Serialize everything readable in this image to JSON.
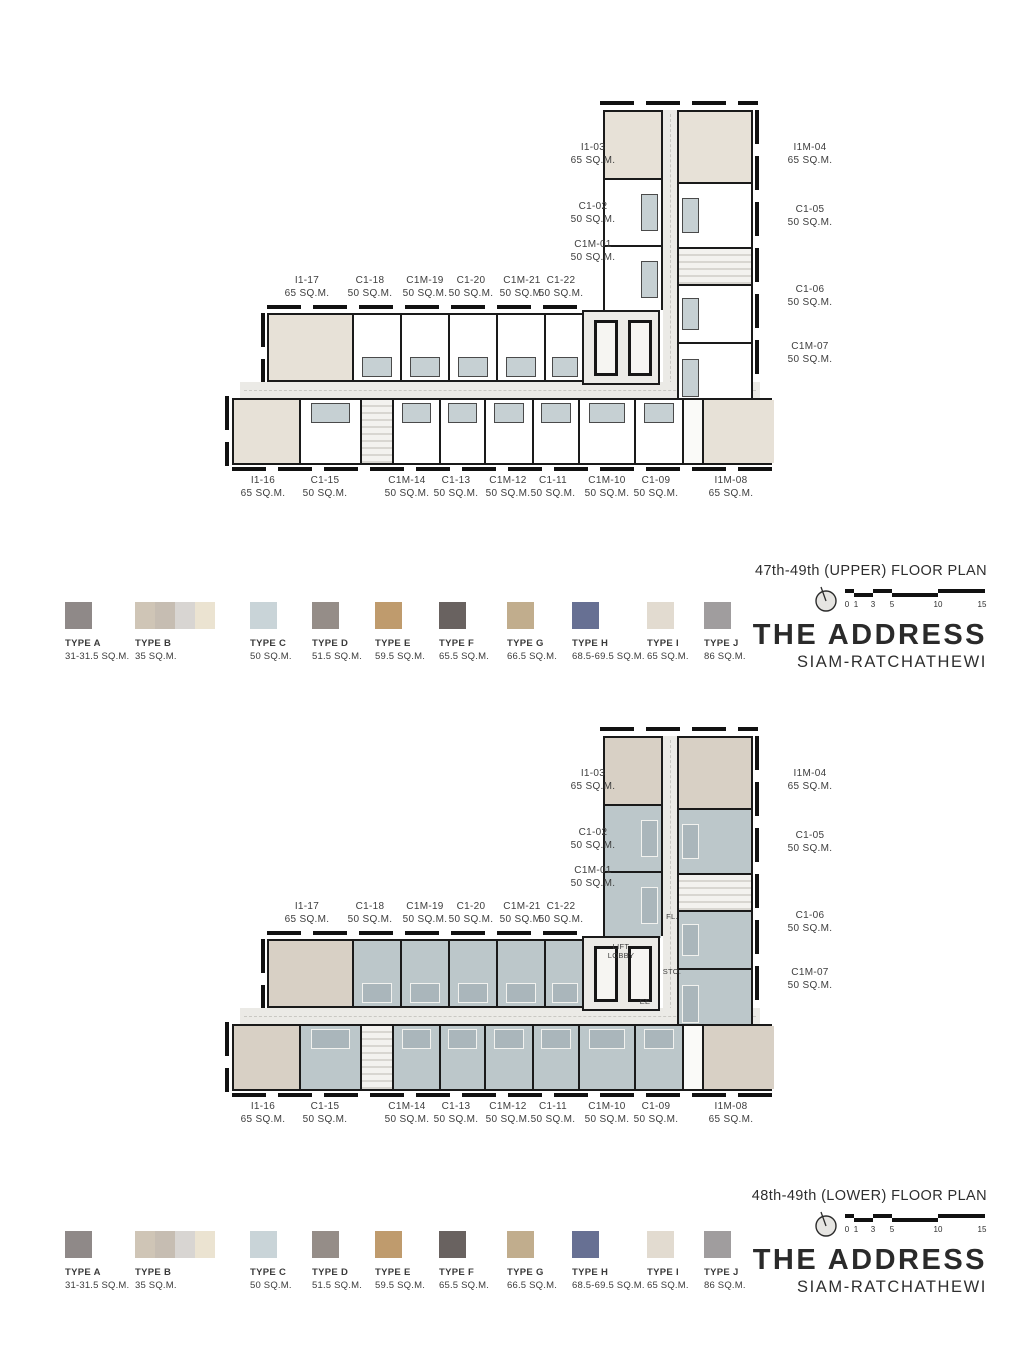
{
  "brand": {
    "title": "THE ADDRESS",
    "subtitle": "SIAM-RATCHATHEWI"
  },
  "plans": [
    {
      "title": "47th-49th (UPPER) FLOOR PLAN"
    },
    {
      "title": "48th-49th (LOWER) FLOOR PLAN"
    }
  ],
  "scalebar": {
    "ticks": [
      "0",
      "1",
      "3",
      "5",
      "10",
      "15"
    ]
  },
  "lower_labels": {
    "fl": "FL.",
    "lift": "LIFT",
    "lobby": "LOBBY",
    "sto": "STO.",
    "ee": "EE"
  },
  "legend": [
    {
      "type": "TYPE A",
      "size": "31-31.5 SQ.M.",
      "color": "#8f8988"
    },
    {
      "type": "TYPE B",
      "size": "35 SQ.M.",
      "colors": [
        "#cfc5b6",
        "#c6bdb2",
        "#d8d5d2",
        "#ebe3d1"
      ]
    },
    {
      "type": "TYPE C",
      "size": "50 SQ.M.",
      "color": "#c9d4d8"
    },
    {
      "type": "TYPE D",
      "size": "51.5 SQ.M.",
      "color": "#958d88"
    },
    {
      "type": "TYPE E",
      "size": "59.5 SQ.M.",
      "color": "#bf9b6d"
    },
    {
      "type": "TYPE F",
      "size": "65.5 SQ.M.",
      "color": "#696260"
    },
    {
      "type": "TYPE G",
      "size": "66.5 SQ.M.",
      "color": "#c1ad8d"
    },
    {
      "type": "TYPE H",
      "size": "68.5-69.5 SQ.M.",
      "color": "#677093"
    },
    {
      "type": "TYPE I",
      "size": "65 SQ.M.",
      "color": "#e2dbd0"
    },
    {
      "type": "TYPE J",
      "size": "86 SQ.M.",
      "color": "#a09d9e"
    }
  ],
  "units": {
    "wing_left_col": [
      {
        "id": "I1-03",
        "size": "65 SQ.M."
      },
      {
        "id": "C1-02",
        "size": "50 SQ.M."
      },
      {
        "id": "C1M-01",
        "size": "50 SQ.M."
      }
    ],
    "wing_right_col": [
      {
        "id": "I1M-04",
        "size": "65 SQ.M."
      },
      {
        "id": "C1-05",
        "size": "50 SQ.M."
      },
      {
        "id": "C1-06",
        "size": "50 SQ.M."
      },
      {
        "id": "C1M-07",
        "size": "50 SQ.M."
      }
    ],
    "top_row": [
      {
        "id": "I1-17",
        "size": "65 SQ.M."
      },
      {
        "id": "C1-18",
        "size": "50 SQ.M."
      },
      {
        "id": "C1M-19",
        "size": "50 SQ.M."
      },
      {
        "id": "C1-20",
        "size": "50 SQ.M."
      },
      {
        "id": "C1M-21",
        "size": "50 SQ.M."
      },
      {
        "id": "C1-22",
        "size": "50 SQ.M."
      }
    ],
    "bottom_row": [
      {
        "id": "I1-16",
        "size": "65 SQ.M."
      },
      {
        "id": "C1-15",
        "size": "50 SQ.M."
      },
      {
        "id": "C1M-14",
        "size": "50 SQ.M."
      },
      {
        "id": "C1-13",
        "size": "50 SQ.M."
      },
      {
        "id": "C1M-12",
        "size": "50 SQ.M."
      },
      {
        "id": "C1-11",
        "size": "50 SQ.M."
      },
      {
        "id": "C1M-10",
        "size": "50 SQ.M."
      },
      {
        "id": "C1-09",
        "size": "50 SQ.M."
      },
      {
        "id": "I1M-08",
        "size": "65 SQ.M."
      }
    ]
  }
}
